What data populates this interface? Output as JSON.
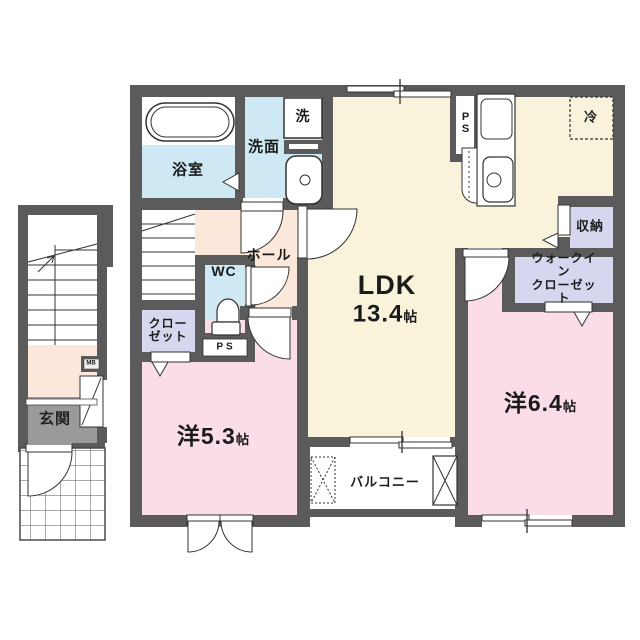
{
  "rooms": {
    "ldk": {
      "name": "LDK",
      "size": "13.4",
      "unit": "帖"
    },
    "west_5_3": {
      "name": "洋5.3",
      "unit": "帖"
    },
    "west_6_4": {
      "name": "洋6.4",
      "unit": "帖"
    },
    "bathroom": {
      "name": "浴室"
    },
    "washroom": {
      "name": "洗面"
    },
    "washer": {
      "name": "洗"
    },
    "toilet": {
      "name": "WC"
    },
    "hall": {
      "name": "ホール"
    },
    "closet": {
      "name": "クロー\nゼット"
    },
    "walk_in_closet": {
      "name": "ウォークイン\nクローゼット"
    },
    "storage": {
      "name": "収納"
    },
    "balcony": {
      "name": "バルコニー"
    },
    "entrance": {
      "name": "玄関"
    },
    "refrigerator": {
      "name": "冷"
    },
    "pipe_space_wc": {
      "name": "PS"
    },
    "pipe_space_kitchen": {
      "name": "PS"
    },
    "meter_box": {
      "name": "MB"
    }
  },
  "colors": {
    "wall": "#5b5b5b",
    "ldk_floor": "#faf3dc",
    "bedroom_floor": "#fadde9",
    "wet_area_floor": "#cfe9f4",
    "closet_floor": "#d6d6ef",
    "hall_floor": "#fbe8da",
    "entrance_floor": "#9a9a9a"
  }
}
